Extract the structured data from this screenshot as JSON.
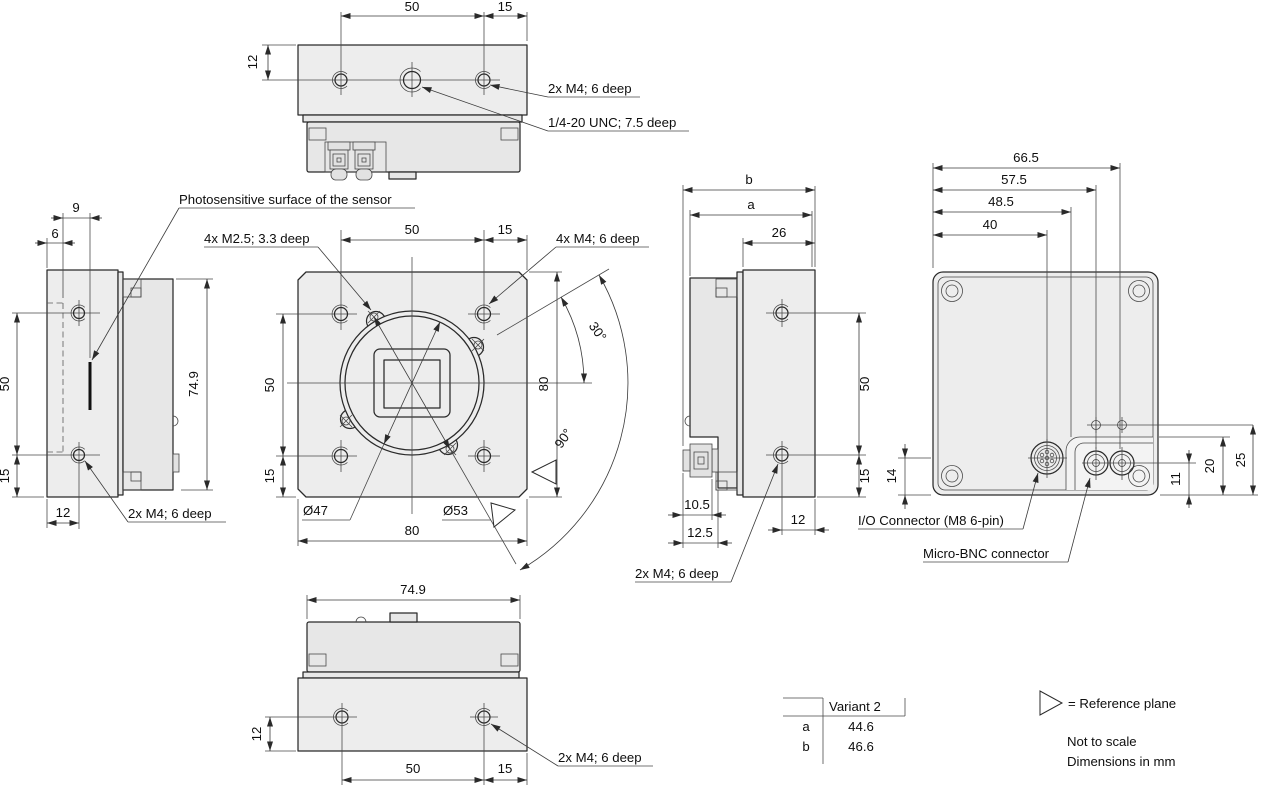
{
  "colors": {
    "line": "#2a2a2a",
    "thin": "#474747",
    "face": "#ededed",
    "body": "#e7e7e7",
    "text": "#0e0e0e"
  },
  "views": {
    "top": {
      "dim_50": "50",
      "dim_15": "15",
      "dim_12": "12",
      "note_m4": "2x M4; 6 deep",
      "note_unc": "1/4-20 UNC; 7.5 deep"
    },
    "left": {
      "dim_9": "9",
      "dim_6": "6",
      "dim_50": "50",
      "dim_15": "15",
      "dim_12": "12",
      "dim_74_9": "74.9",
      "note_sensor": "Photosensitive surface of the sensor",
      "note_m4": "2x M4; 6 deep"
    },
    "front": {
      "dim_top_50": "50",
      "dim_top_15": "15",
      "dim_left_50": "50",
      "dim_left_15": "15",
      "dim_right_80": "80",
      "dim_bottom_80": "80",
      "dim_dia47": "Ø47",
      "dim_dia53": "Ø53",
      "dim_ang30": "30°",
      "dim_ang90": "90°",
      "note_m25": "4x M2.5; 3.3 deep",
      "note_m4": "4x M4; 6 deep"
    },
    "right": {
      "dim_b": "b",
      "dim_a": "a",
      "dim_26": "26",
      "dim_50": "50",
      "dim_15": "15",
      "dim_10_5": "10.5",
      "dim_12_5": "12.5",
      "dim_12": "12",
      "note_m4": "2x M4; 6 deep"
    },
    "back": {
      "dim_66_5": "66.5",
      "dim_57_5": "57.5",
      "dim_48_5": "48.5",
      "dim_40": "40",
      "dim_14": "14",
      "dim_11": "11",
      "dim_20": "20",
      "dim_25": "25",
      "note_io": "I/O Connector (M8 6-pin)",
      "note_bnc": "Micro-BNC connector"
    },
    "bottom": {
      "dim_74_9": "74.9",
      "dim_12": "12",
      "dim_50": "50",
      "dim_15": "15",
      "note_m4": "2x M4; 6 deep"
    }
  },
  "table": {
    "header": "Variant 2",
    "rows": [
      {
        "key": "a",
        "value": "44.6"
      },
      {
        "key": "b",
        "value": "46.6"
      }
    ]
  },
  "legend": {
    "reference": "= Reference plane",
    "scale_note": "Not to scale",
    "units_note": "Dimensions in mm"
  }
}
